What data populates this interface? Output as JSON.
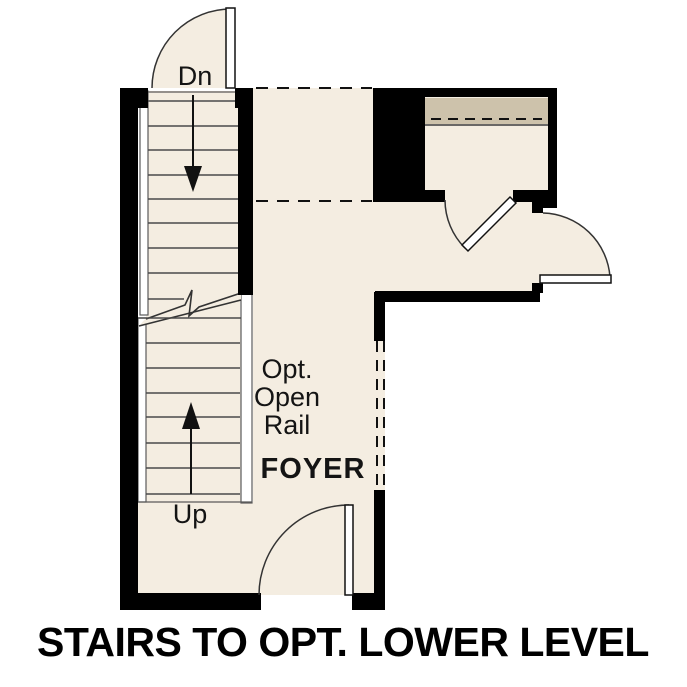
{
  "caption": "STAIRS TO OPT. LOWER LEVEL",
  "plan": {
    "stair_labels": {
      "down": "Dn",
      "up": "Up"
    },
    "rail_note": [
      "Opt.",
      "Open",
      "Rail"
    ],
    "room_label": "FOYER"
  },
  "colors": {
    "wall": "#000000",
    "floor": "#f4ede1",
    "shelf": "#cdc2ab",
    "background": "#ffffff"
  }
}
